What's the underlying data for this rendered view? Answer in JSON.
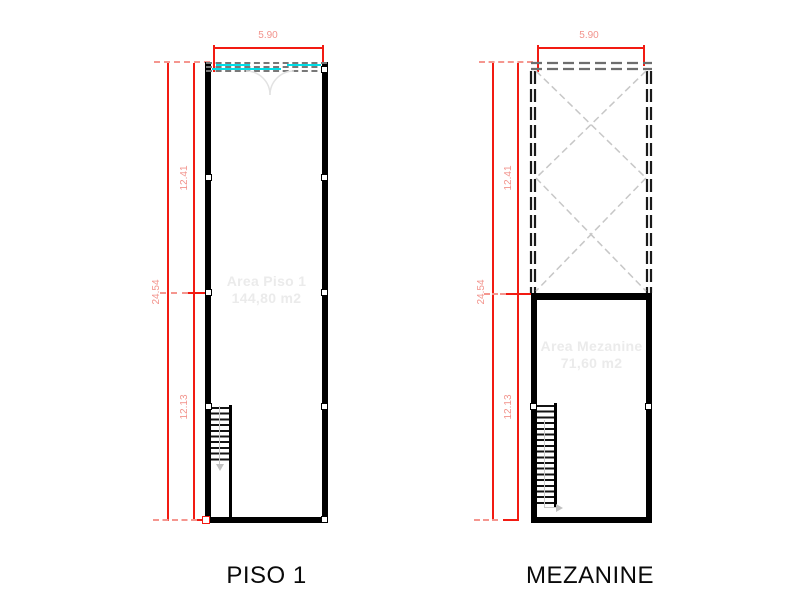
{
  "drawing": {
    "type": "architectural-floor-plan",
    "plans": [
      {
        "id": "piso1",
        "title": "PISO 1",
        "area_line1": "Area Piso 1",
        "area_line2": "144,80 m2",
        "dim_width": "5.90",
        "dim_total": "24.54",
        "dim_upper": "12.41",
        "dim_lower": "12.13"
      },
      {
        "id": "mezanine",
        "title": "MEZANINE",
        "area_line1": "Area Mezanine",
        "area_line2": "71,60 m2",
        "dim_width": "5.90",
        "dim_total": "24.54",
        "dim_upper": "12.41",
        "dim_lower": "12.13"
      }
    ],
    "colors": {
      "background": "#ffffff",
      "wall": "#000000",
      "dimension_line": "#f21b12",
      "dimension_text": "#f2938c",
      "extension_tick": "#f5968f",
      "window_glass": "#00dfe8",
      "window_frame": "#787878",
      "void_hatch": "#c7c7c7",
      "void_wall_dash": "#1a1a1a",
      "area_text": "#ebebeb",
      "stair_arrow": "#c2c2c2",
      "title_text": "#0a0a0a"
    }
  }
}
